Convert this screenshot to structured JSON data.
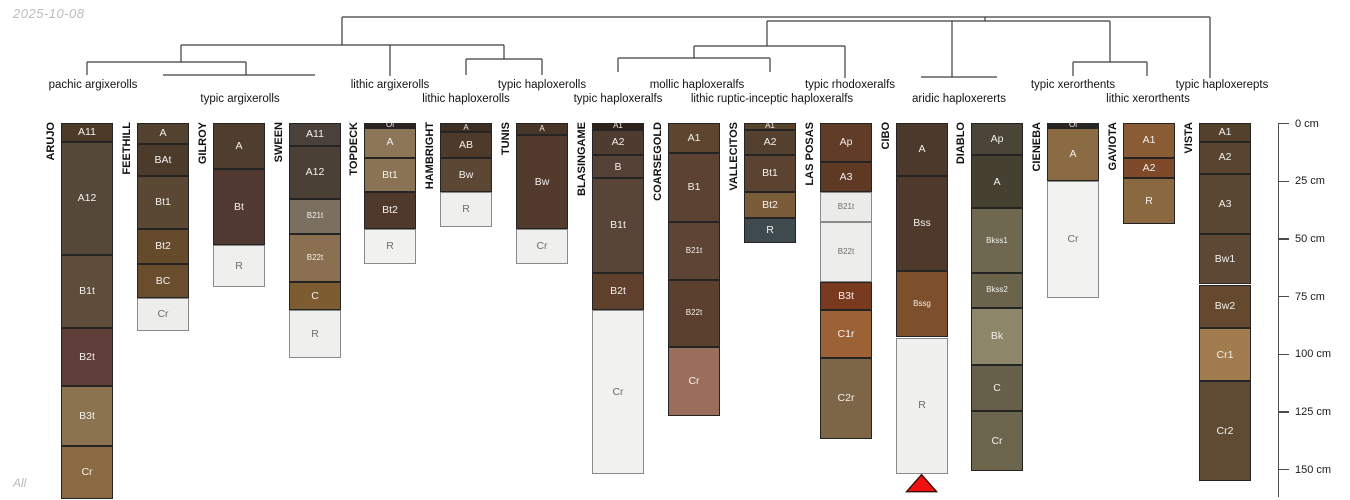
{
  "meta": {
    "date_label": "2025-10-08",
    "footer_label": "All"
  },
  "chart_data": {
    "type": "soil-profile-sketch-with-dendrogram",
    "title": "",
    "depth_axis": {
      "unit": "cm",
      "ticks_cm": [
        0,
        25,
        50,
        75,
        100,
        125,
        150
      ],
      "tick_labels": [
        "0 cm",
        "25 cm",
        "50 cm",
        "75 cm",
        "100 cm",
        "125 cm",
        "150 cm"
      ],
      "range_cm": [
        0,
        162
      ]
    },
    "dendrogram": {
      "line_color": "#3d3d3d",
      "segments": [
        [
          342,
          17,
          1210,
          17
        ],
        [
          342,
          17,
          342,
          45
        ],
        [
          181,
          45,
          504,
          45
        ],
        [
          181,
          45,
          181,
          62
        ],
        [
          87,
          62,
          246,
          62
        ],
        [
          87,
          62,
          87,
          75
        ],
        [
          246,
          62,
          246,
          75
        ],
        [
          163,
          75,
          315,
          75
        ],
        [
          390,
          45,
          390,
          76
        ],
        [
          504,
          45,
          504,
          59
        ],
        [
          466,
          59,
          542,
          59
        ],
        [
          466,
          59,
          466,
          75
        ],
        [
          542,
          59,
          542,
          75
        ],
        [
          985,
          17,
          985,
          21
        ],
        [
          767,
          21,
          1110,
          21
        ],
        [
          767,
          21,
          767,
          46
        ],
        [
          694,
          46,
          845,
          46
        ],
        [
          694,
          46,
          694,
          58
        ],
        [
          618,
          58,
          770,
          58
        ],
        [
          618,
          58,
          618,
          72
        ],
        [
          770,
          58,
          770,
          72
        ],
        [
          845,
          46,
          845,
          78
        ],
        [
          952,
          21,
          952,
          77
        ],
        [
          921,
          77,
          997,
          77
        ],
        [
          1110,
          21,
          1110,
          62
        ],
        [
          1073,
          62,
          1147,
          62
        ],
        [
          1073,
          62,
          1073,
          76
        ],
        [
          1147,
          62,
          1147,
          76
        ],
        [
          1210,
          17,
          1210,
          78
        ]
      ],
      "group_labels": [
        {
          "text": "pachic argixerolls",
          "x": 93,
          "row": 1,
          "members": [
            "ARUJO"
          ]
        },
        {
          "text": "typic argixerolls",
          "x": 240,
          "row": 2,
          "members": [
            "FEETHILL",
            "GILROY",
            "SWEEN"
          ]
        },
        {
          "text": "lithic argixerolls",
          "x": 390,
          "row": 1,
          "members": [
            "TOPDECK"
          ]
        },
        {
          "text": "lithic haploxerolls",
          "x": 466,
          "row": 2,
          "members": [
            "HAMBRIGHT"
          ]
        },
        {
          "text": "typic haploxerolls",
          "x": 542,
          "row": 1,
          "members": [
            "TUNIS"
          ]
        },
        {
          "text": "typic haploxeralfs",
          "x": 618,
          "row": 2,
          "members": [
            "BLASINGAME"
          ]
        },
        {
          "text": "mollic haploxeralfs",
          "x": 697,
          "row": 1,
          "members": [
            "COARSEGOLD"
          ]
        },
        {
          "text": "lithic ruptic-inceptic haploxeralfs",
          "x": 772,
          "row": 2,
          "members": [
            "VALLECITOS"
          ]
        },
        {
          "text": "typic rhodoxeralfs",
          "x": 850,
          "row": 1,
          "members": [
            "LAS POSAS"
          ]
        },
        {
          "text": "aridic haploxererts",
          "x": 959,
          "row": 2,
          "members": [
            "CIBO",
            "DIABLO"
          ]
        },
        {
          "text": "typic xerorthents",
          "x": 1073,
          "row": 1,
          "members": [
            "CIENEBA"
          ]
        },
        {
          "text": "lithic xerorthents",
          "x": 1148,
          "row": 2,
          "members": [
            "GAVIOTA"
          ]
        },
        {
          "text": "typic haploxerepts",
          "x": 1222,
          "row": 1,
          "members": [
            "VISTA"
          ]
        }
      ]
    },
    "profiles": [
      {
        "name": "ARUJO",
        "horizons": [
          {
            "name": "A11",
            "top": 0,
            "bottom": 8,
            "color": "#4d3b29"
          },
          {
            "name": "A12",
            "top": 8,
            "bottom": 57,
            "color": "#564839"
          },
          {
            "name": "B1t",
            "top": 57,
            "bottom": 89,
            "color": "#5d4d3a"
          },
          {
            "name": "B2t",
            "top": 89,
            "bottom": 114,
            "color": "#5f3d39"
          },
          {
            "name": "B3t",
            "top": 114,
            "bottom": 140,
            "color": "#8c7350"
          },
          {
            "name": "Cr",
            "top": 140,
            "bottom": 163,
            "color": "#8a6a42"
          }
        ]
      },
      {
        "name": "FEETHILL",
        "horizons": [
          {
            "name": "A",
            "top": 0,
            "bottom": 9,
            "color": "#52422f"
          },
          {
            "name": "BAt",
            "top": 9,
            "bottom": 23,
            "color": "#4c3b2b"
          },
          {
            "name": "Bt1",
            "top": 23,
            "bottom": 46,
            "color": "#5a4734"
          },
          {
            "name": "Bt2",
            "top": 46,
            "bottom": 61,
            "color": "#654a2c"
          },
          {
            "name": "BC",
            "top": 61,
            "bottom": 76,
            "color": "#6a4d2d"
          },
          {
            "name": "Cr",
            "top": 76,
            "bottom": 90,
            "color": "#ededeb"
          }
        ]
      },
      {
        "name": "GILROY",
        "horizons": [
          {
            "name": "A",
            "top": 0,
            "bottom": 20,
            "color": "#4f3e2e"
          },
          {
            "name": "Bt",
            "top": 20,
            "bottom": 53,
            "color": "#503930"
          },
          {
            "name": "R",
            "top": 53,
            "bottom": 71,
            "color": "#efefed"
          }
        ]
      },
      {
        "name": "SWEEN",
        "horizons": [
          {
            "name": "A11",
            "top": 0,
            "bottom": 10,
            "color": "#49413a"
          },
          {
            "name": "A12",
            "top": 10,
            "bottom": 33,
            "color": "#4a4036"
          },
          {
            "name": "B21t",
            "top": 33,
            "bottom": 48,
            "color": "#7b7060"
          },
          {
            "name": "B22t",
            "top": 48,
            "bottom": 69,
            "color": "#8a7050"
          },
          {
            "name": "C",
            "top": 69,
            "bottom": 81,
            "color": "#7d5c31"
          },
          {
            "name": "R",
            "top": 81,
            "bottom": 102,
            "color": "#efefed"
          }
        ]
      },
      {
        "name": "TOPDECK",
        "horizons": [
          {
            "name": "Oi",
            "top": 0,
            "bottom": 2,
            "color": "#2b2521"
          },
          {
            "name": "A",
            "top": 2,
            "bottom": 15,
            "color": "#8d7557"
          },
          {
            "name": "Bt1",
            "top": 15,
            "bottom": 30,
            "color": "#8a7254"
          },
          {
            "name": "Bt2",
            "top": 30,
            "bottom": 46,
            "color": "#4f392b"
          },
          {
            "name": "R",
            "top": 46,
            "bottom": 61,
            "color": "#f1f1ef"
          }
        ]
      },
      {
        "name": "HAMBRIGHT",
        "horizons": [
          {
            "name": "A",
            "top": 0,
            "bottom": 4,
            "color": "#3e2f24"
          },
          {
            "name": "AB",
            "top": 4,
            "bottom": 15,
            "color": "#4d3a2b"
          },
          {
            "name": "Bw",
            "top": 15,
            "bottom": 30,
            "color": "#5c4634"
          },
          {
            "name": "R",
            "top": 30,
            "bottom": 45,
            "color": "#efefed"
          }
        ]
      },
      {
        "name": "TUNIS",
        "horizons": [
          {
            "name": "A",
            "top": 0,
            "bottom": 5,
            "color": "#483527"
          },
          {
            "name": "Bw",
            "top": 5,
            "bottom": 46,
            "color": "#523b2c"
          },
          {
            "name": "Cr",
            "top": 46,
            "bottom": 61,
            "color": "#efefed"
          }
        ]
      },
      {
        "name": "BLASINGAME",
        "horizons": [
          {
            "name": "A1",
            "top": 0,
            "bottom": 3,
            "color": "#2f211a"
          },
          {
            "name": "A2",
            "top": 3,
            "bottom": 14,
            "color": "#4e3c30"
          },
          {
            "name": "B",
            "top": 14,
            "bottom": 24,
            "color": "#554136"
          },
          {
            "name": "B1t",
            "top": 24,
            "bottom": 65,
            "color": "#594538"
          },
          {
            "name": "B2t",
            "top": 65,
            "bottom": 81,
            "color": "#5e402d"
          },
          {
            "name": "Cr",
            "top": 81,
            "bottom": 152,
            "color": "#f1f1ef"
          }
        ]
      },
      {
        "name": "COARSEGOLD",
        "horizons": [
          {
            "name": "A1",
            "top": 0,
            "bottom": 13,
            "color": "#5e4530"
          },
          {
            "name": "B1",
            "top": 13,
            "bottom": 43,
            "color": "#5c4232"
          },
          {
            "name": "B21t",
            "top": 43,
            "bottom": 68,
            "color": "#5d4434"
          },
          {
            "name": "B22t",
            "top": 68,
            "bottom": 97,
            "color": "#5b4030"
          },
          {
            "name": "Cr",
            "top": 97,
            "bottom": 127,
            "color": "#9b6e5b"
          }
        ]
      },
      {
        "name": "VALLECITOS",
        "horizons": [
          {
            "name": "A1",
            "top": 0,
            "bottom": 3,
            "color": "#57432a"
          },
          {
            "name": "A2",
            "top": 3,
            "bottom": 14,
            "color": "#53402e"
          },
          {
            "name": "Bt1",
            "top": 14,
            "bottom": 30,
            "color": "#5b4332"
          },
          {
            "name": "Bt2",
            "top": 30,
            "bottom": 41,
            "color": "#7a5c38"
          },
          {
            "name": "R",
            "top": 41,
            "bottom": 52,
            "color": "#3f4a4e"
          }
        ]
      },
      {
        "name": "LAS POSAS",
        "horizons": [
          {
            "name": "Ap",
            "top": 0,
            "bottom": 17,
            "color": "#613c26"
          },
          {
            "name": "A3",
            "top": 17,
            "bottom": 30,
            "color": "#5e3a24"
          },
          {
            "name": "B21t",
            "top": 30,
            "bottom": 43,
            "color": "#ebebe9"
          },
          {
            "name": "B22t",
            "top": 43,
            "bottom": 69,
            "color": "#ededeb"
          },
          {
            "name": "B3t",
            "top": 69,
            "bottom": 81,
            "color": "#7a3a20"
          },
          {
            "name": "C1r",
            "top": 81,
            "bottom": 102,
            "color": "#9d6136"
          },
          {
            "name": "C2r",
            "top": 102,
            "bottom": 137,
            "color": "#7d6547"
          }
        ]
      },
      {
        "name": "CIBO",
        "horizons": [
          {
            "name": "A",
            "top": 0,
            "bottom": 23,
            "color": "#4c392b"
          },
          {
            "name": "Bss",
            "top": 23,
            "bottom": 64,
            "color": "#4e392b"
          },
          {
            "name": "Bssg",
            "top": 64,
            "bottom": 93,
            "color": "#7d4f2c"
          },
          {
            "name": "R",
            "top": 93,
            "bottom": 152,
            "color": "#f0f0ee"
          }
        ]
      },
      {
        "name": "DIABLO",
        "horizons": [
          {
            "name": "Ap",
            "top": 0,
            "bottom": 14,
            "color": "#4b4537"
          },
          {
            "name": "A",
            "top": 14,
            "bottom": 37,
            "color": "#45402f"
          },
          {
            "name": "Bkss1",
            "top": 37,
            "bottom": 65,
            "color": "#6e6850"
          },
          {
            "name": "Bkss2",
            "top": 65,
            "bottom": 80,
            "color": "#6a644c"
          },
          {
            "name": "Bk",
            "top": 80,
            "bottom": 105,
            "color": "#8d8668"
          },
          {
            "name": "C",
            "top": 105,
            "bottom": 125,
            "color": "#66604a"
          },
          {
            "name": "Cr",
            "top": 125,
            "bottom": 151,
            "color": "#6b654e"
          }
        ]
      },
      {
        "name": "CIENEBA",
        "horizons": [
          {
            "name": "Oi",
            "top": 0,
            "bottom": 2,
            "color": "#2b2521"
          },
          {
            "name": "A",
            "top": 2,
            "bottom": 25,
            "color": "#8a6b43"
          },
          {
            "name": "Cr",
            "top": 25,
            "bottom": 76,
            "color": "#f2f2f0"
          }
        ]
      },
      {
        "name": "GAVIOTA",
        "horizons": [
          {
            "name": "A1",
            "top": 0,
            "bottom": 15,
            "color": "#8a5c35"
          },
          {
            "name": "A2",
            "top": 15,
            "bottom": 24,
            "color": "#7e4a2a"
          },
          {
            "name": "R",
            "top": 24,
            "bottom": 44,
            "color": "#8a6840"
          }
        ]
      },
      {
        "name": "VISTA",
        "horizons": [
          {
            "name": "A1",
            "top": 0,
            "bottom": 8,
            "color": "#54412c"
          },
          {
            "name": "A2",
            "top": 8,
            "bottom": 22,
            "color": "#584430"
          },
          {
            "name": "A3",
            "top": 22,
            "bottom": 48,
            "color": "#5a4733"
          },
          {
            "name": "Bw1",
            "top": 48,
            "bottom": 70,
            "color": "#5c4834"
          },
          {
            "name": "Bw2",
            "top": 70,
            "bottom": 89,
            "color": "#65492f"
          },
          {
            "name": "Cr1",
            "top": 89,
            "bottom": 112,
            "color": "#a07c4e"
          },
          {
            "name": "Cr2",
            "top": 112,
            "bottom": 155,
            "color": "#5f4a33"
          }
        ]
      }
    ],
    "marker": {
      "profile": "CIBO",
      "shape": "triangle-up",
      "fill": "#f01010",
      "stroke": "#3a0c05"
    }
  }
}
